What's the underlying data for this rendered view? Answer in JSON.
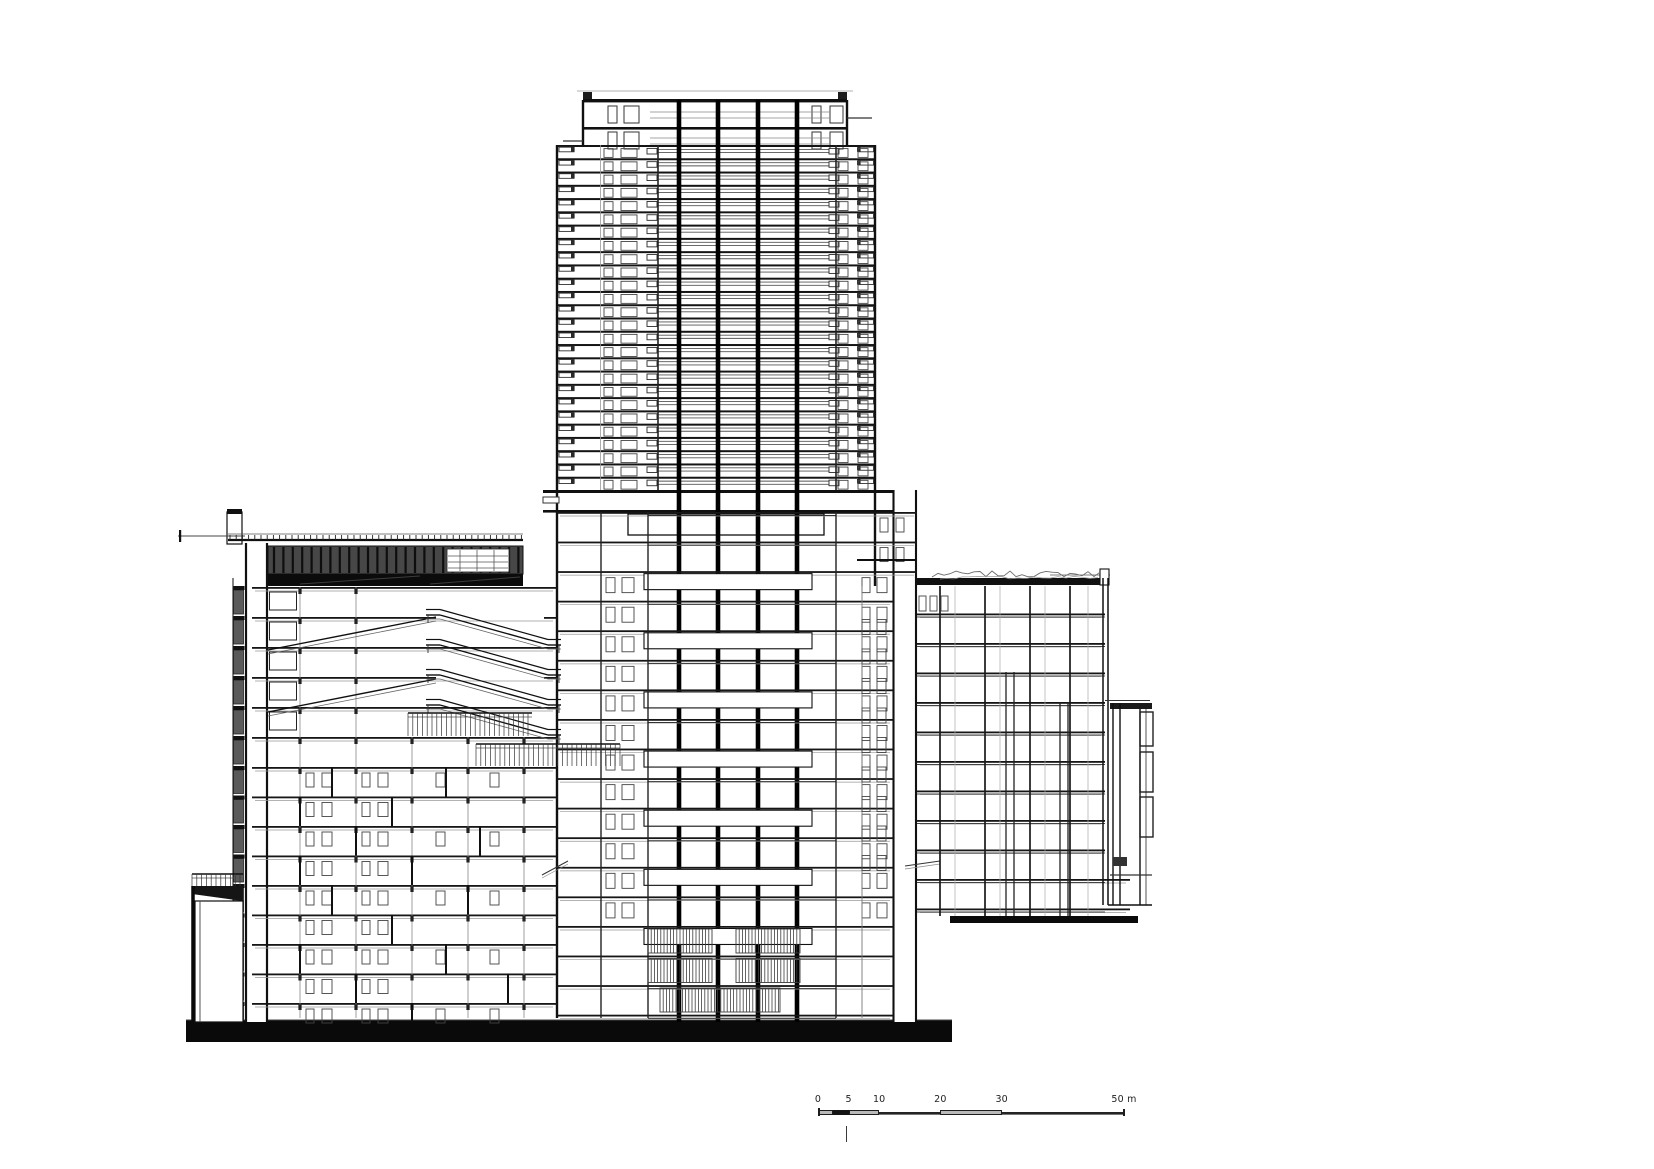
{
  "drawing": {
    "type": "architectural-cross-section",
    "colors": {
      "ink": "#101010",
      "mid": "#333333",
      "soft": "#555555",
      "light": "#999999",
      "faint": "#aaaaaa",
      "screen_fill": "#474747",
      "screen_slat": "#0e0e0e",
      "truss_fill": "#0b0b0b",
      "ground_fill": "#0a0a0a",
      "white": "#ffffff"
    },
    "tower": {
      "floor_count": 26,
      "y_top": 145,
      "y_bottom": 490,
      "x_left": 557,
      "x_right": 875,
      "cap": {
        "x_left": 583,
        "x_right": 847,
        "y_top": 100,
        "y_mid": 127
      },
      "core_columns_x": [
        679,
        718,
        758,
        797
      ]
    },
    "center_podium": {
      "floor_count": 18,
      "y_top": 512,
      "floor_height": 29.57,
      "x_left": 557,
      "x_right": 893,
      "pillar_x": [
        893,
        917
      ]
    },
    "left_wing": {
      "slabs_y": [
        587,
        617,
        647,
        677,
        707,
        737,
        767,
        796.5,
        826,
        855.5,
        885,
        914.5,
        944,
        973.5,
        1003
      ],
      "x_left": 252,
      "x_right": 557,
      "curtain_x": 233,
      "pillar_x": [
        245,
        268
      ],
      "screen": {
        "x1": 268,
        "x2": 523,
        "y1": 546,
        "y2": 574,
        "truss_y2": 586,
        "roofline_y": 540
      },
      "escalator_count": 4
    },
    "right_wing": {
      "slabs_y": [
        613.5,
        643,
        672.5,
        702,
        731.5,
        761,
        790.5,
        820,
        849.5,
        879,
        908.5
      ],
      "x_left": 917,
      "x_right": 1105,
      "roof_y": 578,
      "bottom_bar_y": 916,
      "annex": {
        "x1": 1110,
        "x2": 1152,
        "y1": 703,
        "y2": 905
      }
    },
    "ground": {
      "x1": 186,
      "x2": 952,
      "y1": 1020,
      "y2": 1042
    }
  },
  "scale_bar": {
    "labels": [
      "0",
      "5",
      "10",
      "20",
      "30",
      "50 m"
    ],
    "values_m": [
      0,
      5,
      10,
      20,
      30,
      50
    ],
    "px_per_m": 6.12,
    "length_m": 50
  }
}
